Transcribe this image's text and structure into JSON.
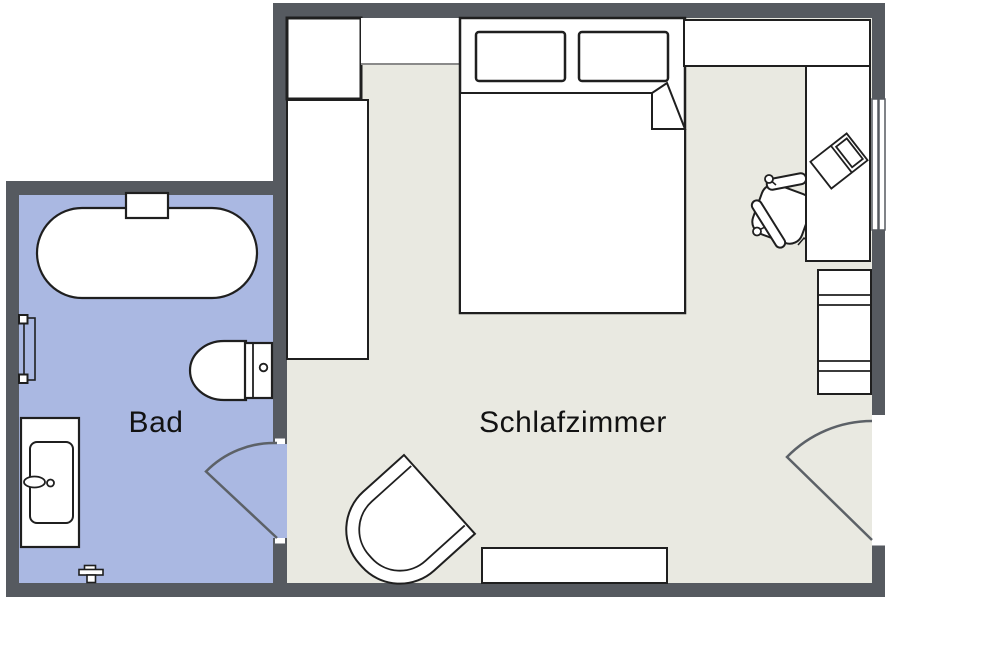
{
  "floorplan": {
    "type": "apartment-floor-plan",
    "labels": {
      "bad": "Bad",
      "schlafzimmer": "Schlafzimmer"
    },
    "rooms": [
      {
        "name": "Bad",
        "floor_color": "#aab8e2",
        "furniture": [
          "bathtub",
          "bathtub-faucet",
          "toilet",
          "sink-vanity",
          "wall-radiator",
          "floor-valve"
        ],
        "doors": [
          "door-to-schlafzimmer"
        ]
      },
      {
        "name": "Schlafzimmer",
        "floor_color": "#e9e9e1",
        "furniture": [
          "nightstand",
          "wardrobe",
          "wall-shelf",
          "double-bed",
          "pillow-left",
          "pillow-right",
          "duvet",
          "top-cabinet",
          "desk",
          "laptop",
          "office-chair",
          "dresser",
          "armchair",
          "bench"
        ],
        "doors": [
          "door-to-bad",
          "entry-door"
        ],
        "windows": [
          "window-right-wall"
        ]
      }
    ],
    "colors": {
      "wall": "#565a60",
      "bad_floor": "#aab8e2",
      "schlafzimmer_floor": "#e9e9e1",
      "furniture_fill": "#ffffff",
      "furniture_outline": "#1f1f1f",
      "door_swing": "#5c6167",
      "shelf_edge": "#8a8a8a",
      "label_text": "#121212"
    }
  }
}
